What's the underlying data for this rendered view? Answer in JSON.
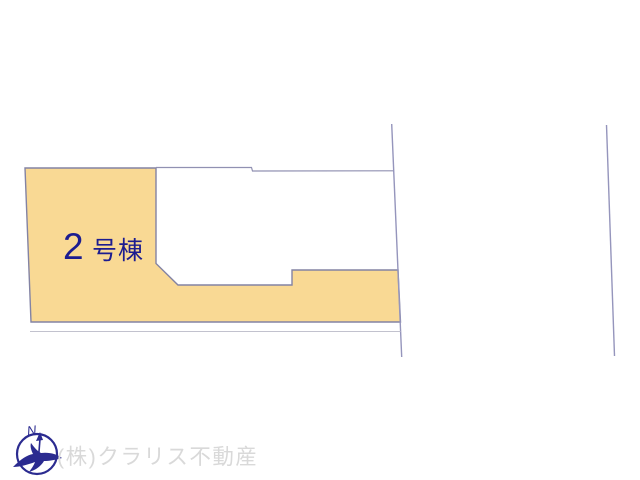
{
  "plot_plan": {
    "parcel": {
      "label_full": "2号棟",
      "label_number": "2",
      "label_suffix": "号棟",
      "label_color": "#1c1c90",
      "fill_color": "#f9d994",
      "border_color": "#8383a4"
    },
    "neighbor_parcel_outline_color": "#9191b2",
    "right_boundary_line_color": "#9595bc",
    "faint_setback_line_color": "#c2c2ce"
  },
  "footer": {
    "company_name": "(株)クラリス不動産",
    "company_text_color": "#d9d9d9",
    "logo_color": "#2b2b90",
    "logo_letter": "N"
  }
}
